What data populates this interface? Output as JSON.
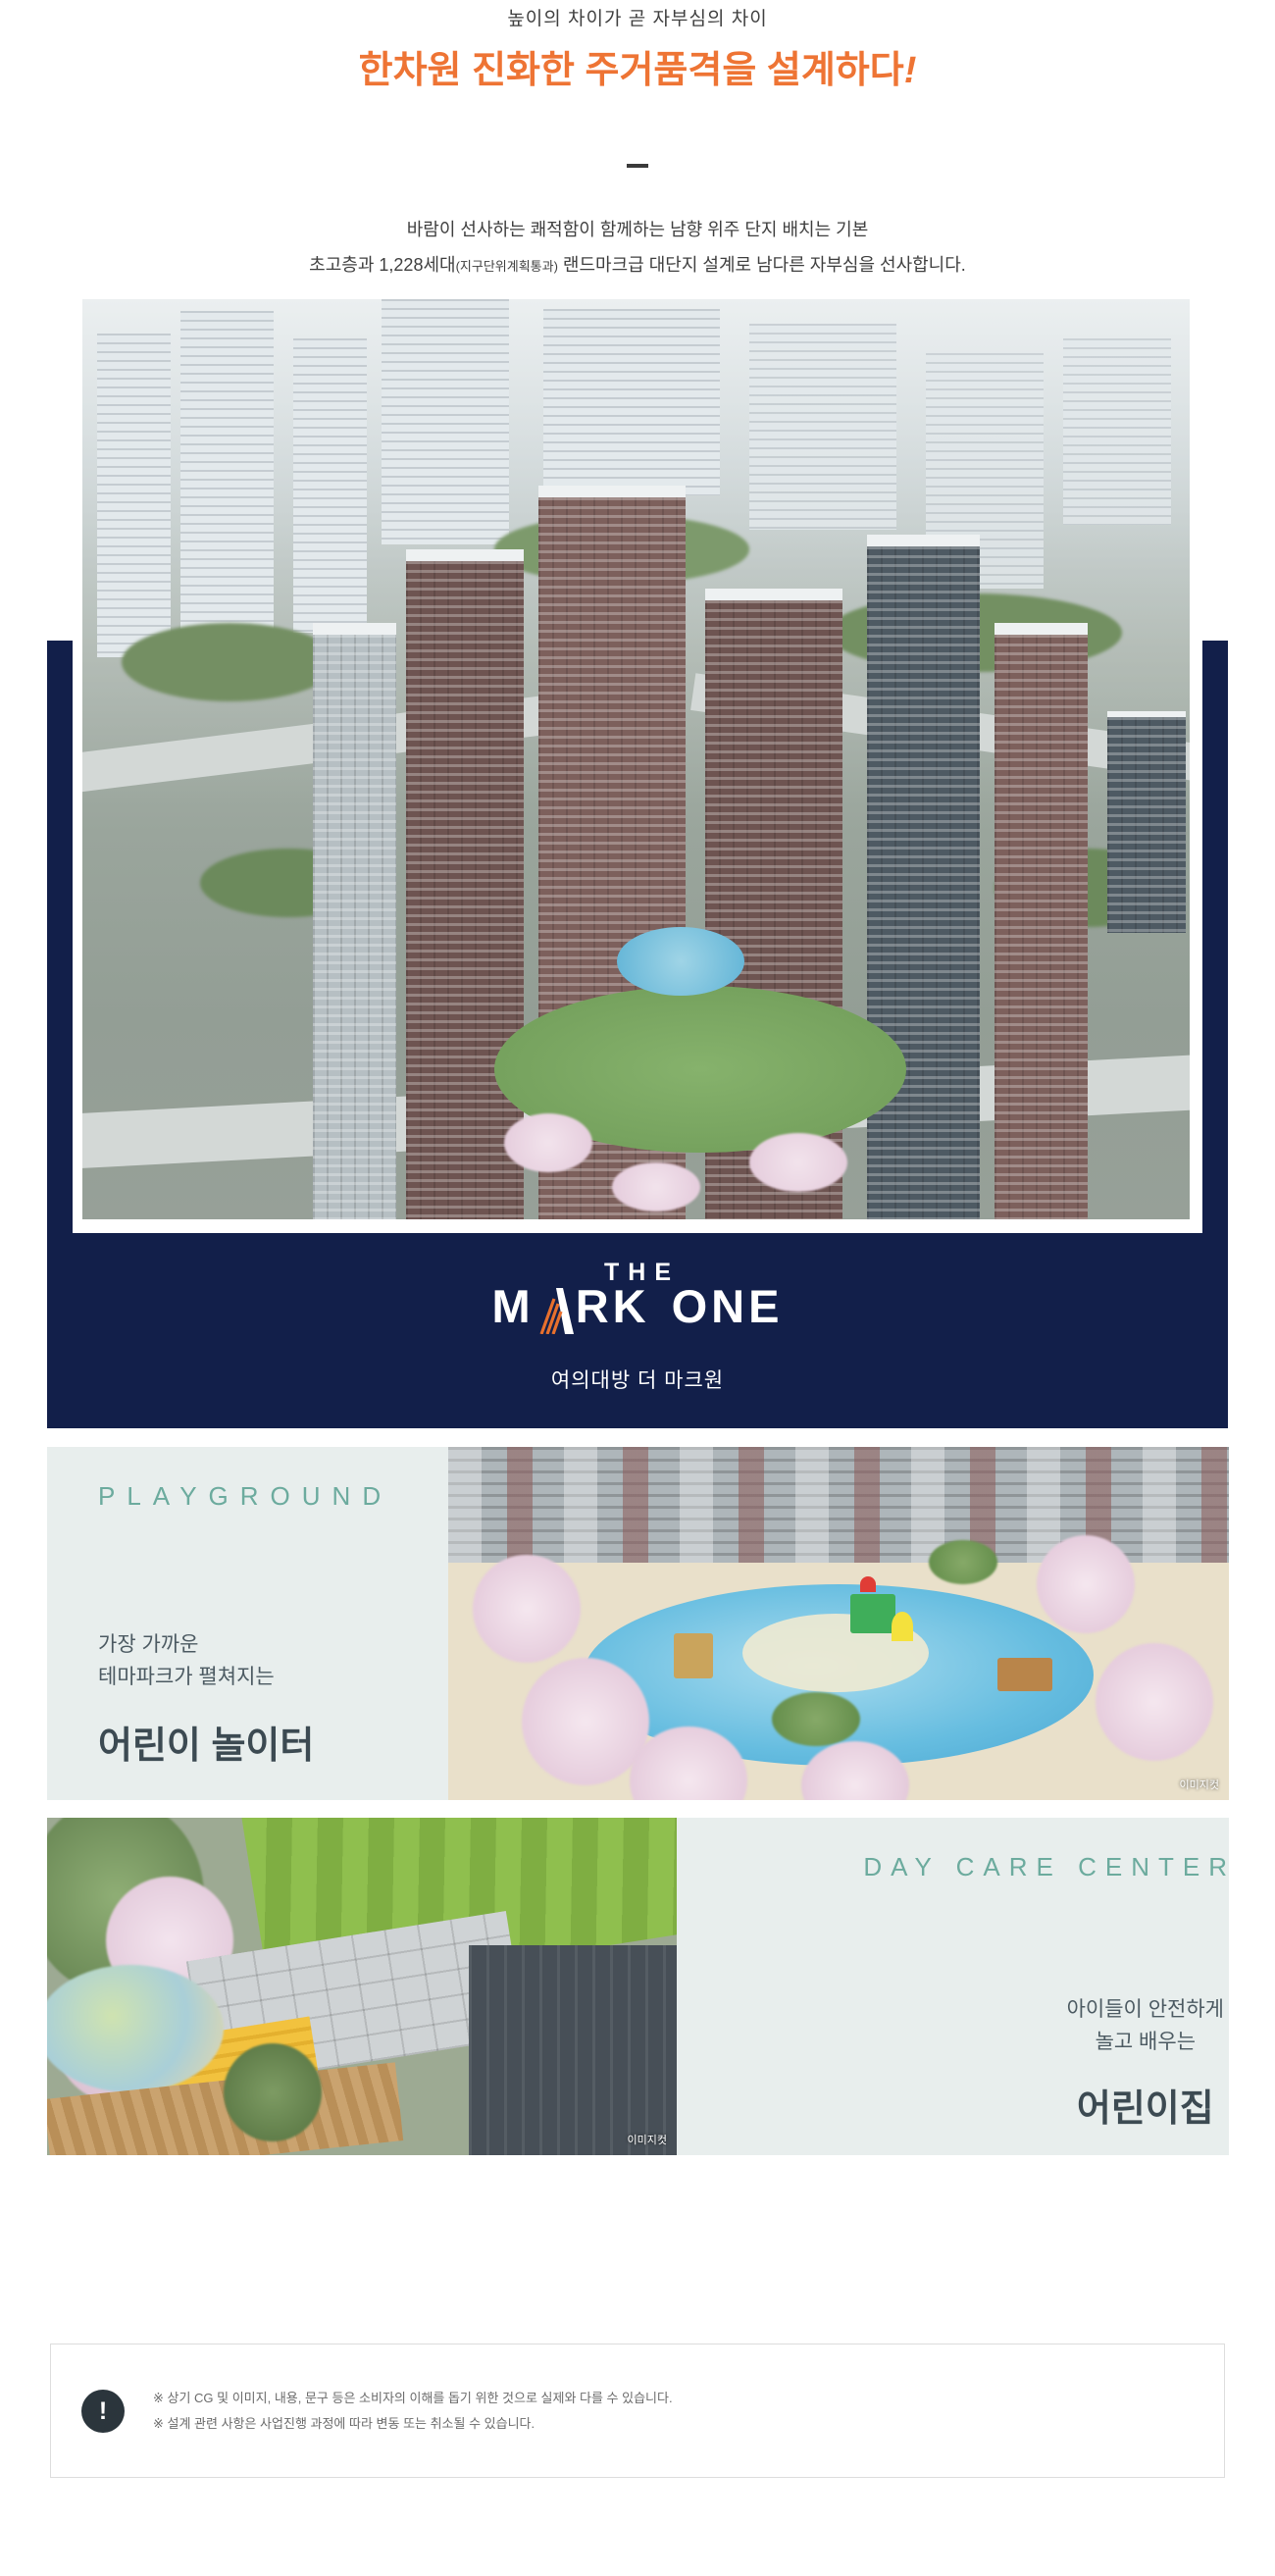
{
  "colors": {
    "navy": "#121f4a",
    "accent_orange": "#ee7434",
    "teal": "#6cab9e",
    "mint_panel": "#e8eeed",
    "heading_dark": "#3c4a52",
    "logo_accent": "#e8702d"
  },
  "header": {
    "eyebrow": "높이의 차이가 곧 자부심의 차이",
    "title": "한차원 진화한 주거품격을 설계하다",
    "title_bang": "!",
    "desc1": "바람이 선사하는 쾌적함이 함께하는 남향 위주 단지 배치는 기본",
    "desc2_a": "초고층과 1,228세대",
    "desc2_small": "(지구단위계획통과)",
    "desc2_b": " 랜드마크급 대단지 설계로 남다른 자부심을 선사합니다."
  },
  "brand": {
    "the": "THE",
    "m": "M",
    "rk": "RK",
    "one": "ONE",
    "subtitle": "여의대방 더 마크원"
  },
  "playground": {
    "label": "PLAYGROUND",
    "sub1": "가장 가까운",
    "sub2": "테마파크가 펼쳐지는",
    "title": "어린이 놀이터",
    "caption": "이미지컷"
  },
  "daycare": {
    "label": "DAY CARE CENTER",
    "sub1": "아이들이 안전하게",
    "sub2": "놀고 배우는",
    "title": "어린이집",
    "caption": "이미지컷"
  },
  "disclaimer": {
    "icon": "!",
    "line1": "※ 상기 CG 및 이미지, 내용, 문구 등은 소비자의 이해를 돕기 위한 것으로 실제와 다를 수 있습니다.",
    "line2": "※ 설계 관련 사항은 사업진행 과정에 따라 변동 또는 취소될 수 있습니다."
  }
}
